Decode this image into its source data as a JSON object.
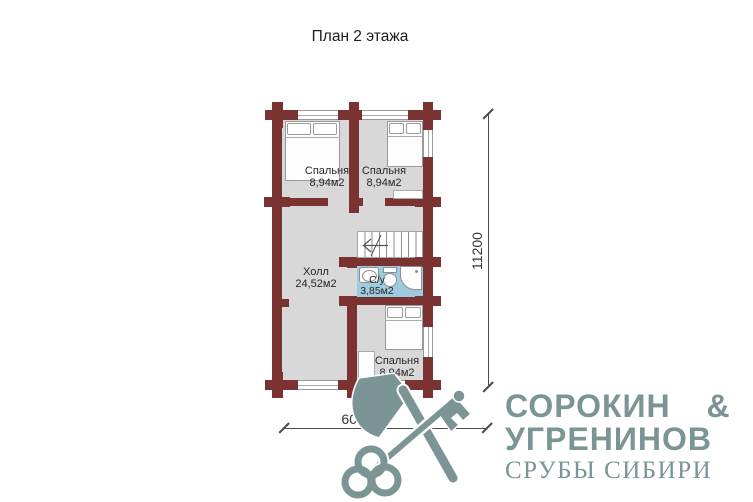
{
  "title": "План 2 этажа",
  "rooms": {
    "bedroom_tl": {
      "name": "Спальня",
      "area": "8,94м2"
    },
    "bedroom_tr": {
      "name": "Спальня",
      "area": "8,94м2"
    },
    "bedroom_b": {
      "name": "Спальня",
      "area": "8,94м2"
    },
    "hall": {
      "name": "Холл",
      "area": "24,52м2"
    },
    "bathroom": {
      "name": "С/у",
      "area": "3,85м2"
    }
  },
  "dimensions": {
    "vertical": "11200",
    "horizontal": "6000"
  },
  "logo": {
    "line1": "СОРОКИН &",
    "line2": "УГРЕНИНОВ",
    "line3": "СРУБЫ СИБИРИ",
    "icon": "crossed-axe-and-key"
  },
  "colors": {
    "wall": "#7a3331",
    "floor": "#d8d8d8",
    "bathroom_floor": "#9fcbe0",
    "logo": "#7b9495"
  }
}
